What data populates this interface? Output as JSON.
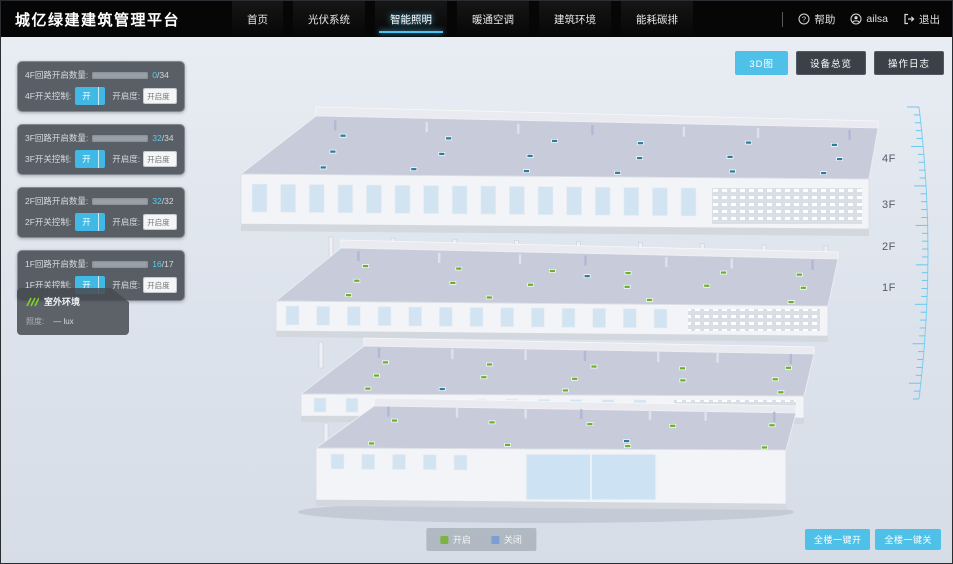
{
  "header": {
    "title": "城亿绿建建筑管理平台",
    "nav": [
      {
        "label": "首页",
        "active": false
      },
      {
        "label": "光伏系统",
        "active": false
      },
      {
        "label": "智能照明",
        "active": true
      },
      {
        "label": "暖通空调",
        "active": false
      },
      {
        "label": "建筑环境",
        "active": false
      },
      {
        "label": "能耗碳排",
        "active": false
      }
    ],
    "help": "帮助",
    "user": "ailsa",
    "logout": "退出"
  },
  "toolbar": {
    "view_3d": "3D图",
    "device_overview": "设备总览",
    "operation_log": "操作日志"
  },
  "panels": [
    {
      "count_label": "4F回路开启数量:",
      "open": "0",
      "total": "/34",
      "progress": 0,
      "switch_label": "4F开关控制:",
      "on": "开",
      "off": "关",
      "dim_label": "开启度:",
      "dim_placeholder": "开启度",
      "percent": "%"
    },
    {
      "count_label": "3F回路开启数量:",
      "open": "32",
      "total": "/34",
      "progress": 94,
      "switch_label": "3F开关控制:",
      "on": "开",
      "off": "关",
      "dim_label": "开启度:",
      "dim_placeholder": "开启度",
      "percent": "%"
    },
    {
      "count_label": "2F回路开启数量:",
      "open": "32",
      "total": "/32",
      "progress": 100,
      "switch_label": "2F开关控制:",
      "on": "开",
      "off": "关",
      "dim_label": "开启度:",
      "dim_placeholder": "开启度",
      "percent": "%"
    },
    {
      "count_label": "1F回路开启数量:",
      "open": "16",
      "total": "/17",
      "progress": 94,
      "switch_label": "1F开关控制:",
      "on": "开",
      "off": "关",
      "dim_label": "开启度:",
      "dim_placeholder": "开启度",
      "percent": "%"
    }
  ],
  "env_panel": {
    "title": "室外环境",
    "illuminance_label": "照度:",
    "illuminance_value": "— lux"
  },
  "floor_scale": {
    "labels": [
      "4F",
      "3F",
      "2F",
      "1F"
    ]
  },
  "legend": {
    "on_label": "开启",
    "on_color": "#7cb342",
    "off_label": "关闭",
    "off_color": "#7b9fd4"
  },
  "bulk": {
    "all_on": "全楼一键开",
    "all_off": "全楼一键关"
  },
  "building": {
    "open_marker": "#69b02c",
    "closed_marker": "#2e7ba0"
  }
}
